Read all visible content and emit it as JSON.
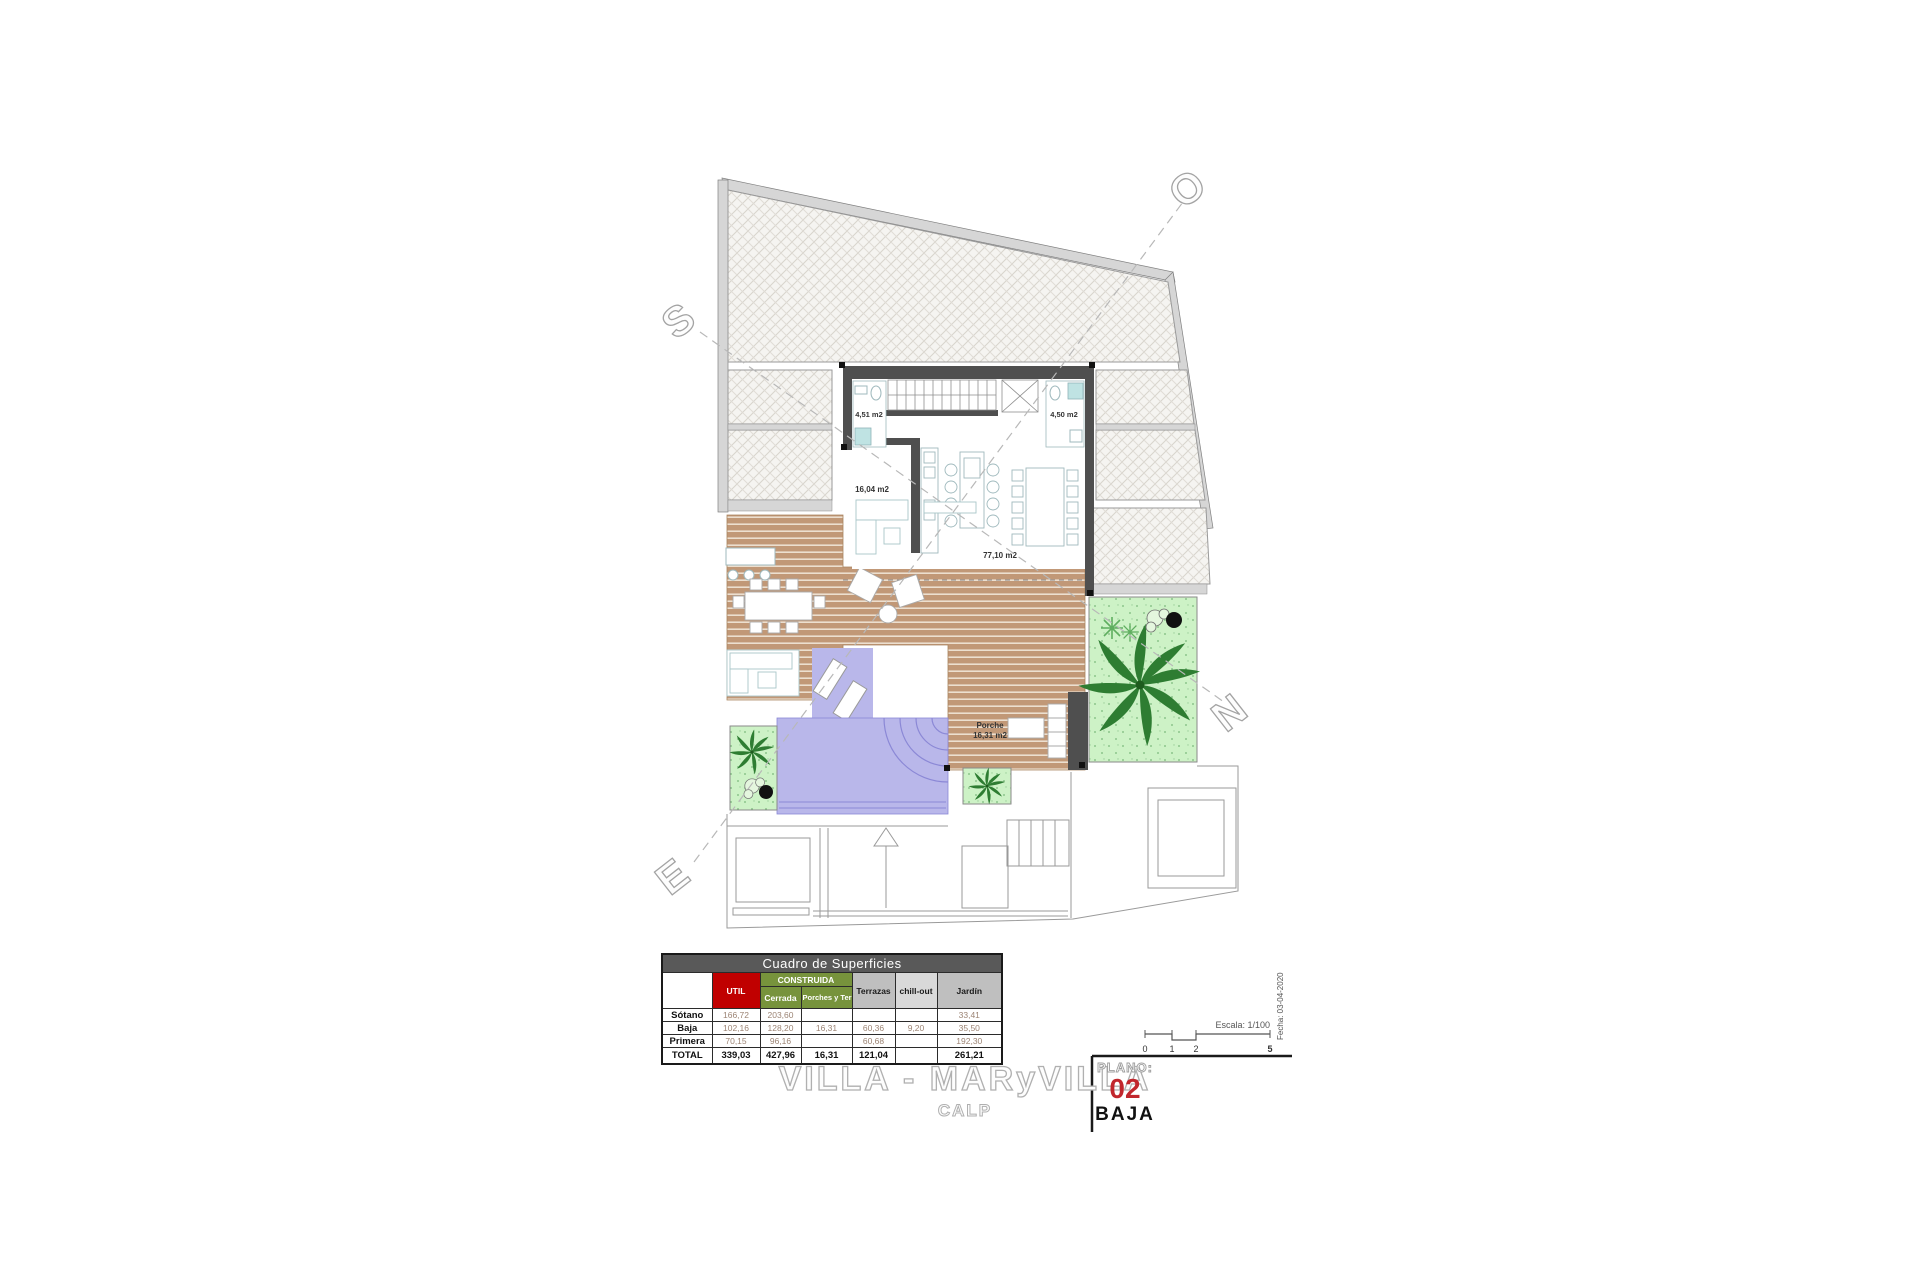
{
  "plan": {
    "area_labels": {
      "bath_left": "4,51 m2",
      "bath_right": "4,50 m2",
      "kitchen": "16,04 m2",
      "living": "77,10 m2",
      "porch_name": "Porche",
      "porch_area": "16,31 m2"
    },
    "compass": {
      "south": "S",
      "west": "O",
      "east": "E",
      "north": "N"
    }
  },
  "surface_table": {
    "title": "Cuadro de Superficies",
    "headers": {
      "util": "UTIL",
      "construida": "CONSTRUIDA",
      "cerrada": "Cerrada",
      "porches": "Porches y Terrazas",
      "terrazas": "Terrazas",
      "chillout": "chill-out",
      "jardin": "Jardín"
    },
    "rows": [
      {
        "label": "Sótano",
        "util": "166,72",
        "cerrada": "203,60",
        "porches": "",
        "terrazas": "",
        "chillout": "",
        "jardin": "33,41"
      },
      {
        "label": "Baja",
        "util": "102,16",
        "cerrada": "128,20",
        "porches": "16,31",
        "terrazas": "60,36",
        "chillout": "9,20",
        "jardin": "35,50"
      },
      {
        "label": "Primera",
        "util": "70,15",
        "cerrada": "96,16",
        "porches": "",
        "terrazas": "60,68",
        "chillout": "",
        "jardin": "192,30"
      },
      {
        "label": "TOTAL",
        "util": "339,03",
        "cerrada": "427,96",
        "porches": "16,31",
        "terrazas": "121,04",
        "chillout": "",
        "jardin": "261,21"
      }
    ]
  },
  "title_block": {
    "project": "VILLA - MARyVILLA",
    "location": "CALP",
    "plano_label": "PLANO:",
    "plano_number": "02",
    "plano_name": "BAJA"
  },
  "scale_bar": {
    "escala": "Escala: 1/100",
    "fecha": "Fecha: 03-04-2020",
    "tick0": "0",
    "tick1": "1",
    "tick2": "2",
    "tick5": "5"
  },
  "colors": {
    "accent_red": "#c1272d",
    "table_title_grey": "#595959",
    "util_red": "#c00000",
    "construida_green": "#77933c",
    "pool_lavender": "#b9b7ea",
    "deck_tan": "#c19877",
    "garden_green": "#cdf2c6",
    "wall_grey": "#4f4f4f"
  }
}
